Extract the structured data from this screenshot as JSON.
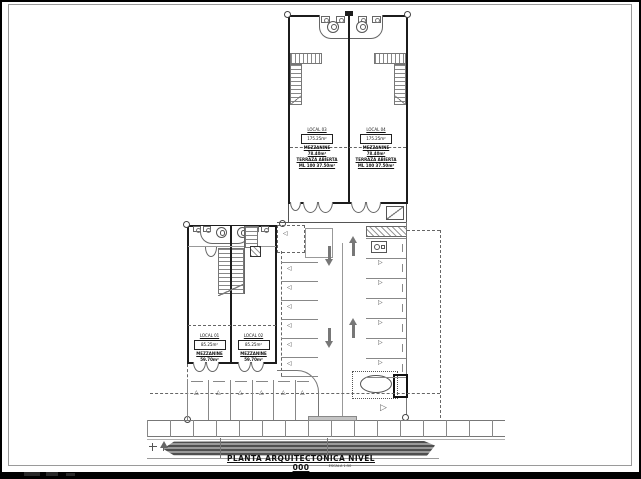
{
  "drawing": {
    "title": "PLANTA ARQUITECTONICA NIVEL 000",
    "scale_note": "ESCALA 1:50"
  },
  "upper_units": [
    {
      "name": "LOCAL 03",
      "area": "175.25m²",
      "mezzanine": "MEZZANINE 78.40m²",
      "terrace": "TERRAZA ABIERTA",
      "note": "ML 100 37.50m²"
    },
    {
      "name": "LOCAL 04",
      "area": "175.25m²",
      "mezzanine": "MEZZANINE 78.40m²",
      "terrace": "TERRAZA ABIERTA",
      "note": "ML 100 37.50m²"
    }
  ],
  "lower_units": [
    {
      "name": "LOCAL 01",
      "area": "85.25m²",
      "mezzanine": "MEZZANINE 59.70m²"
    },
    {
      "name": "LOCAL 02",
      "area": "85.25m²",
      "mezzanine": "MEZZANINE 59.70m²"
    }
  ],
  "parking": {
    "left_column_spaces": 7,
    "right_column_spaces": 7,
    "bottom_row_spaces": 6,
    "traffic_arrows": [
      "down",
      "up",
      "down",
      "up"
    ]
  },
  "icons": {
    "parking_space_marker": "◁",
    "parking_space_marker_right": "▷",
    "stall_marker": "△"
  },
  "colors": {
    "background": "#000000",
    "paper": "#ffffff",
    "ink": "#1c1c1c",
    "line_gray": "#777777",
    "road_gray": "#8a8a8a"
  }
}
